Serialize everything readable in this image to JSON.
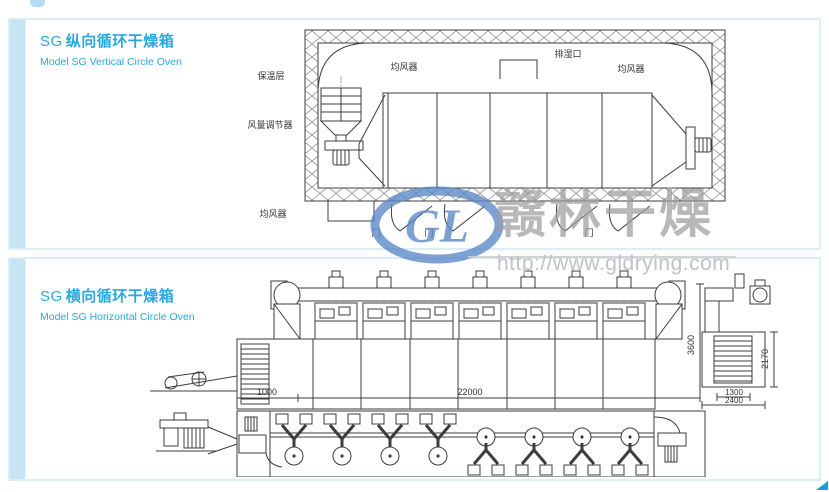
{
  "watermark": {
    "logo_initials": "GL",
    "brand": "赣林干燥",
    "url": "http://www.gldrying.com"
  },
  "panels": {
    "vertical": {
      "title_code": "SG",
      "title_cn": "纵向循环干燥箱",
      "subtitle": "Model SG Vertical Circle Oven",
      "labels": {
        "insulation_layer": "保温层",
        "air_distributor_top": "均风器",
        "moisture_exhaust": "排湿口",
        "air_distributor_right": "均风器",
        "air_volume_regulator": "风量调节器",
        "air_distributor_bottom": "均风器",
        "door": "门"
      }
    },
    "horizontal": {
      "title_code": "SG",
      "title_cn": "横向循环干燥箱",
      "subtitle": "Model SG Horizontal Circle Oven",
      "dimensions": {
        "inlet_section_length": "1000",
        "total_length": "22000",
        "overall_height": "3600",
        "side_body_height": "2170",
        "side_inner_width": "1300",
        "side_overall_width": "2400"
      }
    }
  },
  "colors": {
    "accent_blue": "#29a9e0",
    "panel_border": "#d9eef9",
    "panel_strip": "#c7e4f4",
    "drawing_line": "#3c3c3c",
    "watermark_logo": "#5b87c9",
    "watermark_text": "#9e9e9e"
  }
}
